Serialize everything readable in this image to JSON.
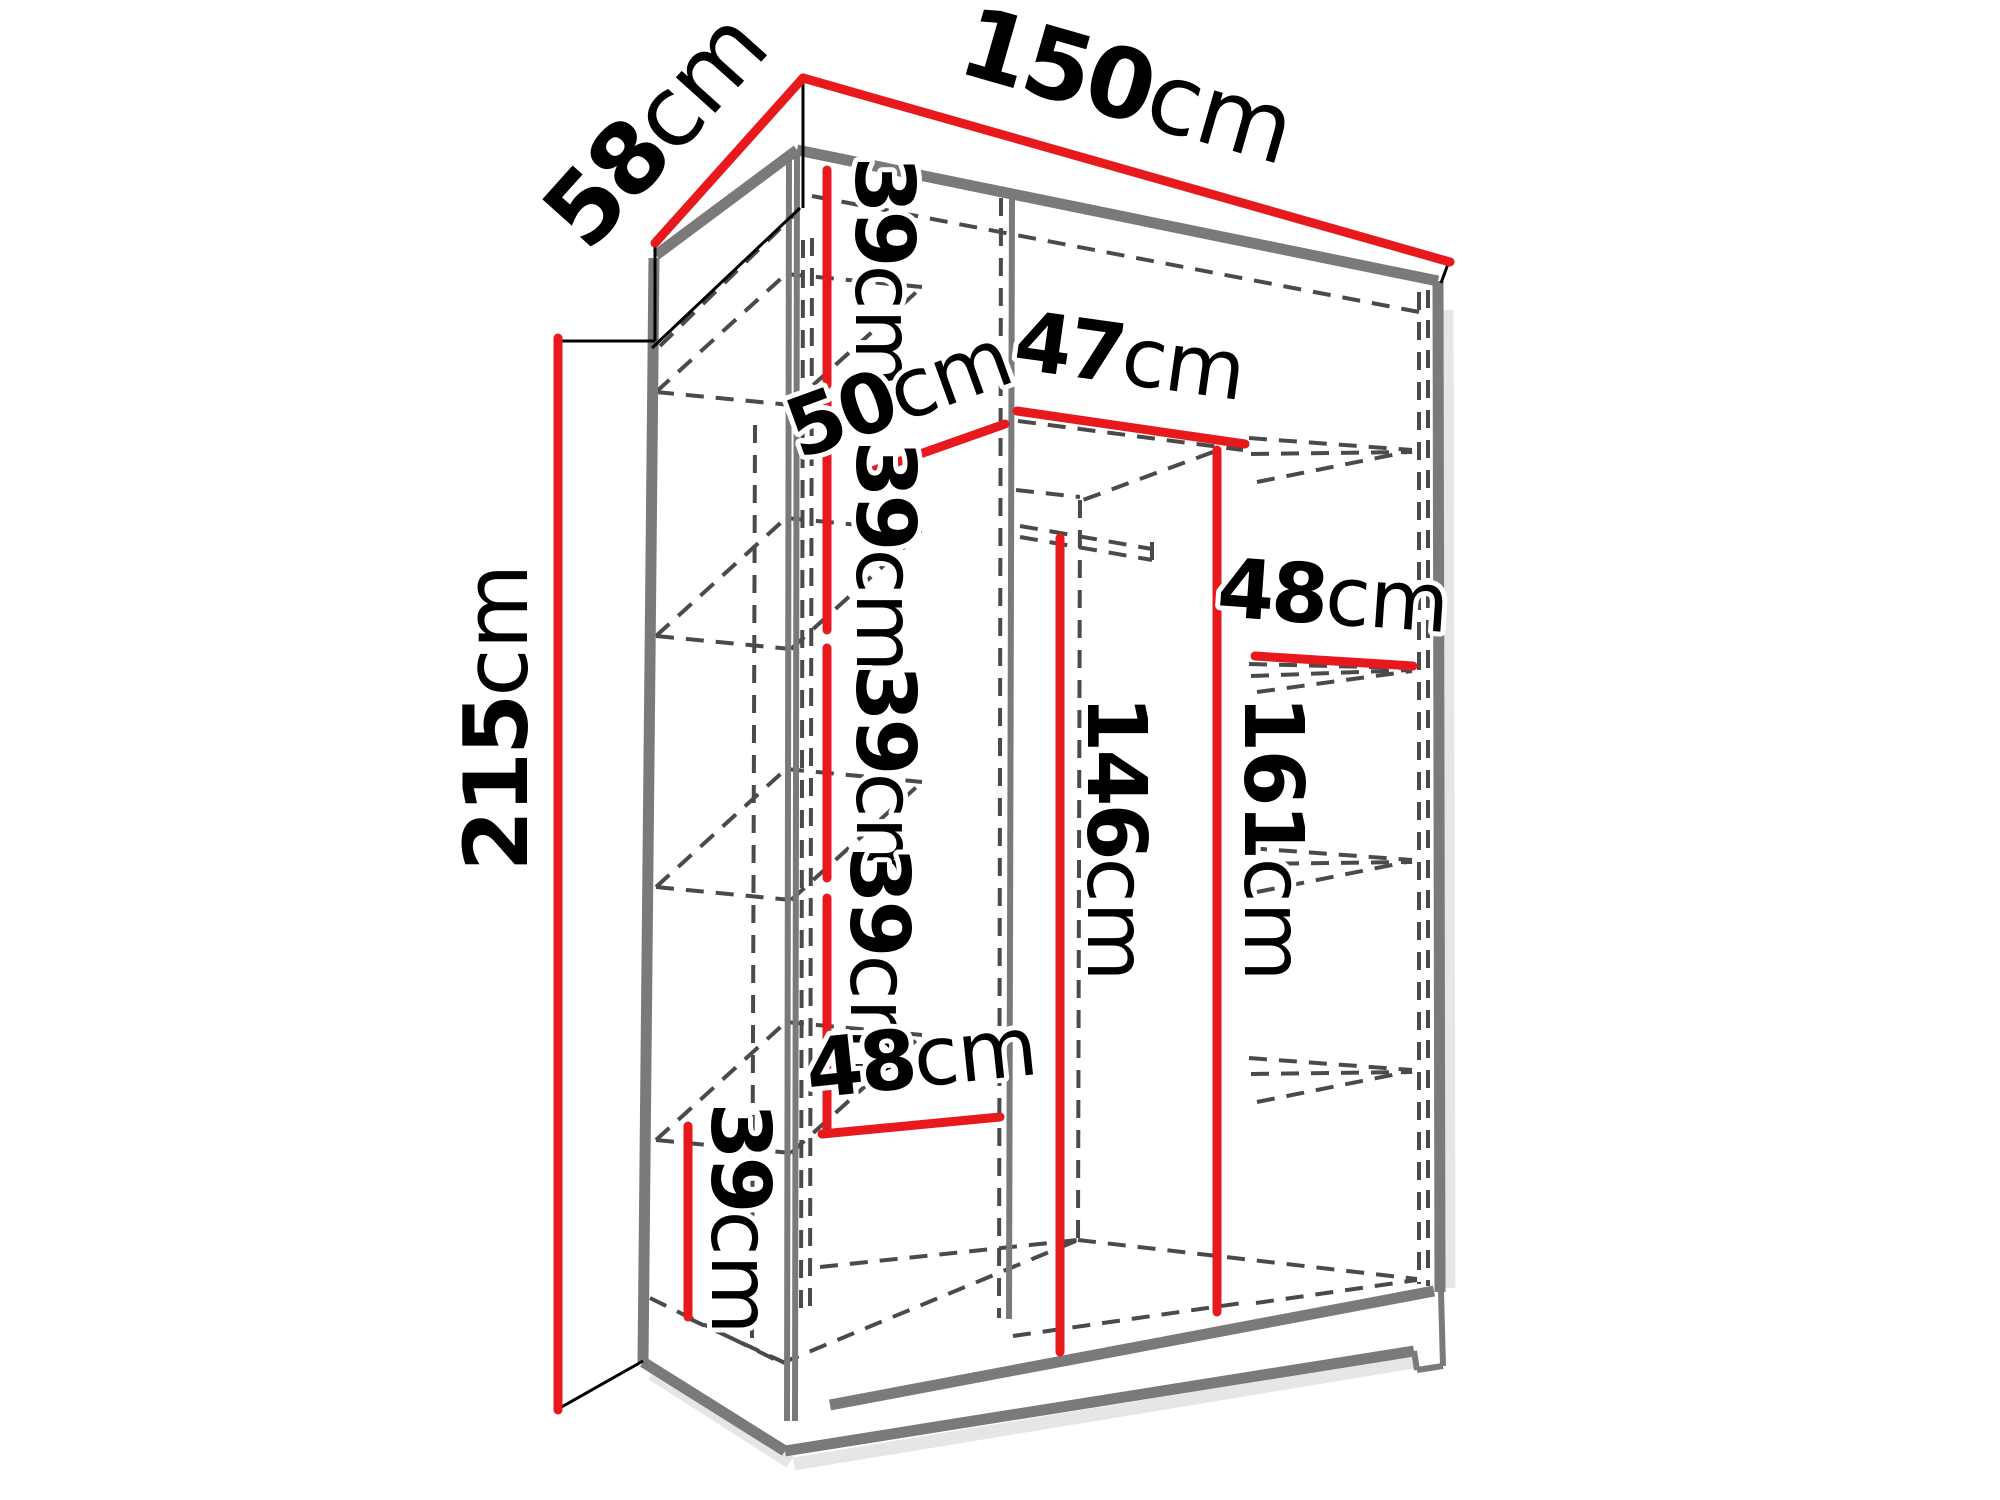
{
  "diagram_title": "wardrobe-internal-dimensions",
  "canvas": {
    "width": 2000,
    "height": 1500,
    "background": "#ffffff"
  },
  "colors": {
    "accent_red": "#e8191c",
    "structure_gray": "#7a7a7a",
    "hidden_dash_gray": "#4a4a4a",
    "ink_black": "#000000",
    "shadow_gray": "#d9d9d9"
  },
  "dimensions": [
    {
      "id": "top-width-150",
      "value": "150",
      "unit": "cm",
      "line": [
        803,
        78,
        1450,
        262
      ],
      "label": {
        "x": 1118,
        "y": 118,
        "rotate": 16,
        "size": 97
      }
    },
    {
      "id": "top-depth-58",
      "value": "58",
      "unit": "cm",
      "line": [
        803,
        78,
        655,
        243
      ],
      "label": {
        "x": 680,
        "y": 152,
        "rotate": -48,
        "size": 97
      }
    },
    {
      "id": "side-height-215",
      "value": "215",
      "unit": "cm",
      "line": [
        558,
        338,
        558,
        1410
      ],
      "label": {
        "x": 527,
        "y": 718,
        "rotate": -90,
        "size": 88
      }
    },
    {
      "id": "left-gap-39-a",
      "value": "39",
      "unit": "cm",
      "line": [
        827,
        170,
        827,
        385
      ],
      "label": {
        "x": 856,
        "y": 272,
        "rotate": 90,
        "size": 82
      }
    },
    {
      "id": "shelf-depth-50",
      "value": "50",
      "unit": "cm",
      "line": [
        858,
        476,
        1005,
        424
      ],
      "label": {
        "x": 908,
        "y": 420,
        "rotate": -20,
        "size": 82
      }
    },
    {
      "id": "mid-width-47",
      "value": "47",
      "unit": "cm",
      "line": [
        1017,
        411,
        1245,
        444
      ],
      "label": {
        "x": 1126,
        "y": 384,
        "rotate": 8,
        "size": 82
      }
    },
    {
      "id": "left-gap-39-b",
      "value": "39",
      "unit": "cm",
      "line": [
        827,
        402,
        827,
        630
      ],
      "label": {
        "x": 857,
        "y": 556,
        "rotate": 90,
        "size": 82
      }
    },
    {
      "id": "right-width-48",
      "value": "48",
      "unit": "cm",
      "line": [
        1255,
        656,
        1413,
        666
      ],
      "label": {
        "x": 1331,
        "y": 624,
        "rotate": 4,
        "size": 82
      }
    },
    {
      "id": "left-gap-39-c",
      "value": "39",
      "unit": "cm",
      "line": [
        827,
        648,
        827,
        878
      ],
      "label": {
        "x": 857,
        "y": 780,
        "rotate": 90,
        "size": 82
      }
    },
    {
      "id": "hang-height-146",
      "value": "146",
      "unit": "cm",
      "line": [
        1060,
        538,
        1060,
        1352
      ],
      "label": {
        "x": 1088,
        "y": 838,
        "rotate": 90,
        "size": 82
      }
    },
    {
      "id": "hang-height-161",
      "value": "161",
      "unit": "cm",
      "line": [
        1217,
        450,
        1217,
        1312
      ],
      "label": {
        "x": 1245,
        "y": 838,
        "rotate": 90,
        "size": 82
      }
    },
    {
      "id": "left-gap-39-d",
      "value": "39",
      "unit": "cm",
      "line": [
        827,
        898,
        827,
        1132
      ],
      "label": {
        "x": 851,
        "y": 962,
        "rotate": 90,
        "size": 82
      }
    },
    {
      "id": "bottom-width-48",
      "value": "48",
      "unit": "cm",
      "line": [
        822,
        1134,
        1000,
        1117
      ],
      "label": {
        "x": 924,
        "y": 1086,
        "rotate": -6,
        "size": 82
      }
    },
    {
      "id": "bottom-gap-39",
      "value": "39",
      "unit": "cm",
      "line": [
        688,
        1126,
        688,
        1317
      ],
      "label": {
        "x": 712,
        "y": 1218,
        "rotate": 90,
        "size": 82
      }
    }
  ],
  "structure": {
    "shadow_lines": [
      [
        794,
        1464,
        1414,
        1362
      ],
      [
        1447,
        310,
        1449,
        1288
      ],
      [
        652,
        1374,
        790,
        1462
      ]
    ],
    "solid_thick": [
      [
        797,
        150,
        1438,
        281
      ],
      [
        797,
        150,
        656,
        255
      ],
      [
        654,
        258,
        643,
        1362
      ],
      [
        1438,
        281,
        1440,
        1292
      ],
      [
        643,
        1362,
        785,
        1451
      ],
      [
        785,
        1451,
        1414,
        1351
      ],
      [
        830,
        1405,
        1434,
        1291
      ]
    ],
    "solid_medium": [
      [
        789,
        152,
        787,
        1421
      ],
      [
        797,
        153,
        795,
        1421
      ],
      [
        1012,
        196,
        1009,
        1319
      ],
      [
        1414,
        1351,
        1417,
        1370
      ],
      [
        1417,
        1370,
        1443,
        1366
      ],
      [
        1443,
        1366,
        1441,
        1292
      ]
    ],
    "solid_thin": [
      [
        803,
        78,
        803,
        208
      ],
      [
        1448,
        264,
        1441,
        283
      ],
      [
        655,
        245,
        655,
        341
      ],
      [
        558,
        341,
        655,
        341
      ],
      [
        558,
        1409,
        643,
        1361
      ],
      [
        800,
        208,
        652,
        348
      ]
    ],
    "dashed": [
      [
        803,
        240,
        801,
        1310
      ],
      [
        812,
        238,
        810,
        1308
      ],
      [
        1001,
        198,
        999,
        1318
      ],
      [
        1080,
        500,
        1078,
        1240
      ],
      [
        1419,
        292,
        1419,
        1284
      ],
      [
        1428,
        290,
        1428,
        1286
      ],
      [
        755,
        425,
        752,
        1338
      ],
      [
        812,
        196,
        1419,
        312
      ],
      [
        660,
        346,
        797,
        212
      ],
      [
        1020,
        526,
        1152,
        549
      ],
      [
        1020,
        537,
        1152,
        560
      ],
      [
        1152,
        542,
        1152,
        563
      ],
      [
        1018,
        421,
        1243,
        450
      ],
      [
        1213,
        452,
        1083,
        500
      ],
      [
        1016,
        490,
        1080,
        497
      ],
      [
        656,
        392,
        791,
        405
      ],
      [
        786,
        274,
        922,
        287
      ],
      [
        656,
        392,
        786,
        274
      ],
      [
        791,
        405,
        922,
        287
      ],
      [
        656,
        636,
        791,
        649
      ],
      [
        786,
        518,
        922,
        531
      ],
      [
        656,
        636,
        786,
        518
      ],
      [
        791,
        649,
        922,
        531
      ],
      [
        656,
        887,
        791,
        900
      ],
      [
        786,
        769,
        922,
        782
      ],
      [
        656,
        887,
        786,
        769
      ],
      [
        791,
        900,
        922,
        782
      ],
      [
        656,
        1140,
        791,
        1153
      ],
      [
        786,
        1022,
        922,
        1035
      ],
      [
        656,
        1140,
        786,
        1022
      ],
      [
        791,
        1153,
        922,
        1035
      ],
      [
        1249,
        438,
        1412,
        450
      ],
      [
        1251,
        454,
        1412,
        452
      ],
      [
        1257,
        482,
        1412,
        451
      ],
      [
        1249,
        664,
        1412,
        668
      ],
      [
        1251,
        676,
        1412,
        670
      ],
      [
        1257,
        692,
        1412,
        671
      ],
      [
        1249,
        848,
        1412,
        860
      ],
      [
        1251,
        864,
        1412,
        862
      ],
      [
        1257,
        892,
        1412,
        861
      ],
      [
        1249,
        1058,
        1412,
        1070
      ],
      [
        1251,
        1074,
        1412,
        1072
      ],
      [
        1257,
        1102,
        1412,
        1071
      ],
      [
        650,
        1298,
        782,
        1363
      ],
      [
        688,
        1318,
        783,
        1362
      ],
      [
        782,
        1363,
        1078,
        1240
      ],
      [
        820,
        1267,
        1078,
        1240
      ],
      [
        1078,
        1240,
        1417,
        1279
      ],
      [
        1256,
        1303,
        1417,
        1280
      ],
      [
        1013,
        1336,
        1249,
        1302
      ]
    ]
  }
}
